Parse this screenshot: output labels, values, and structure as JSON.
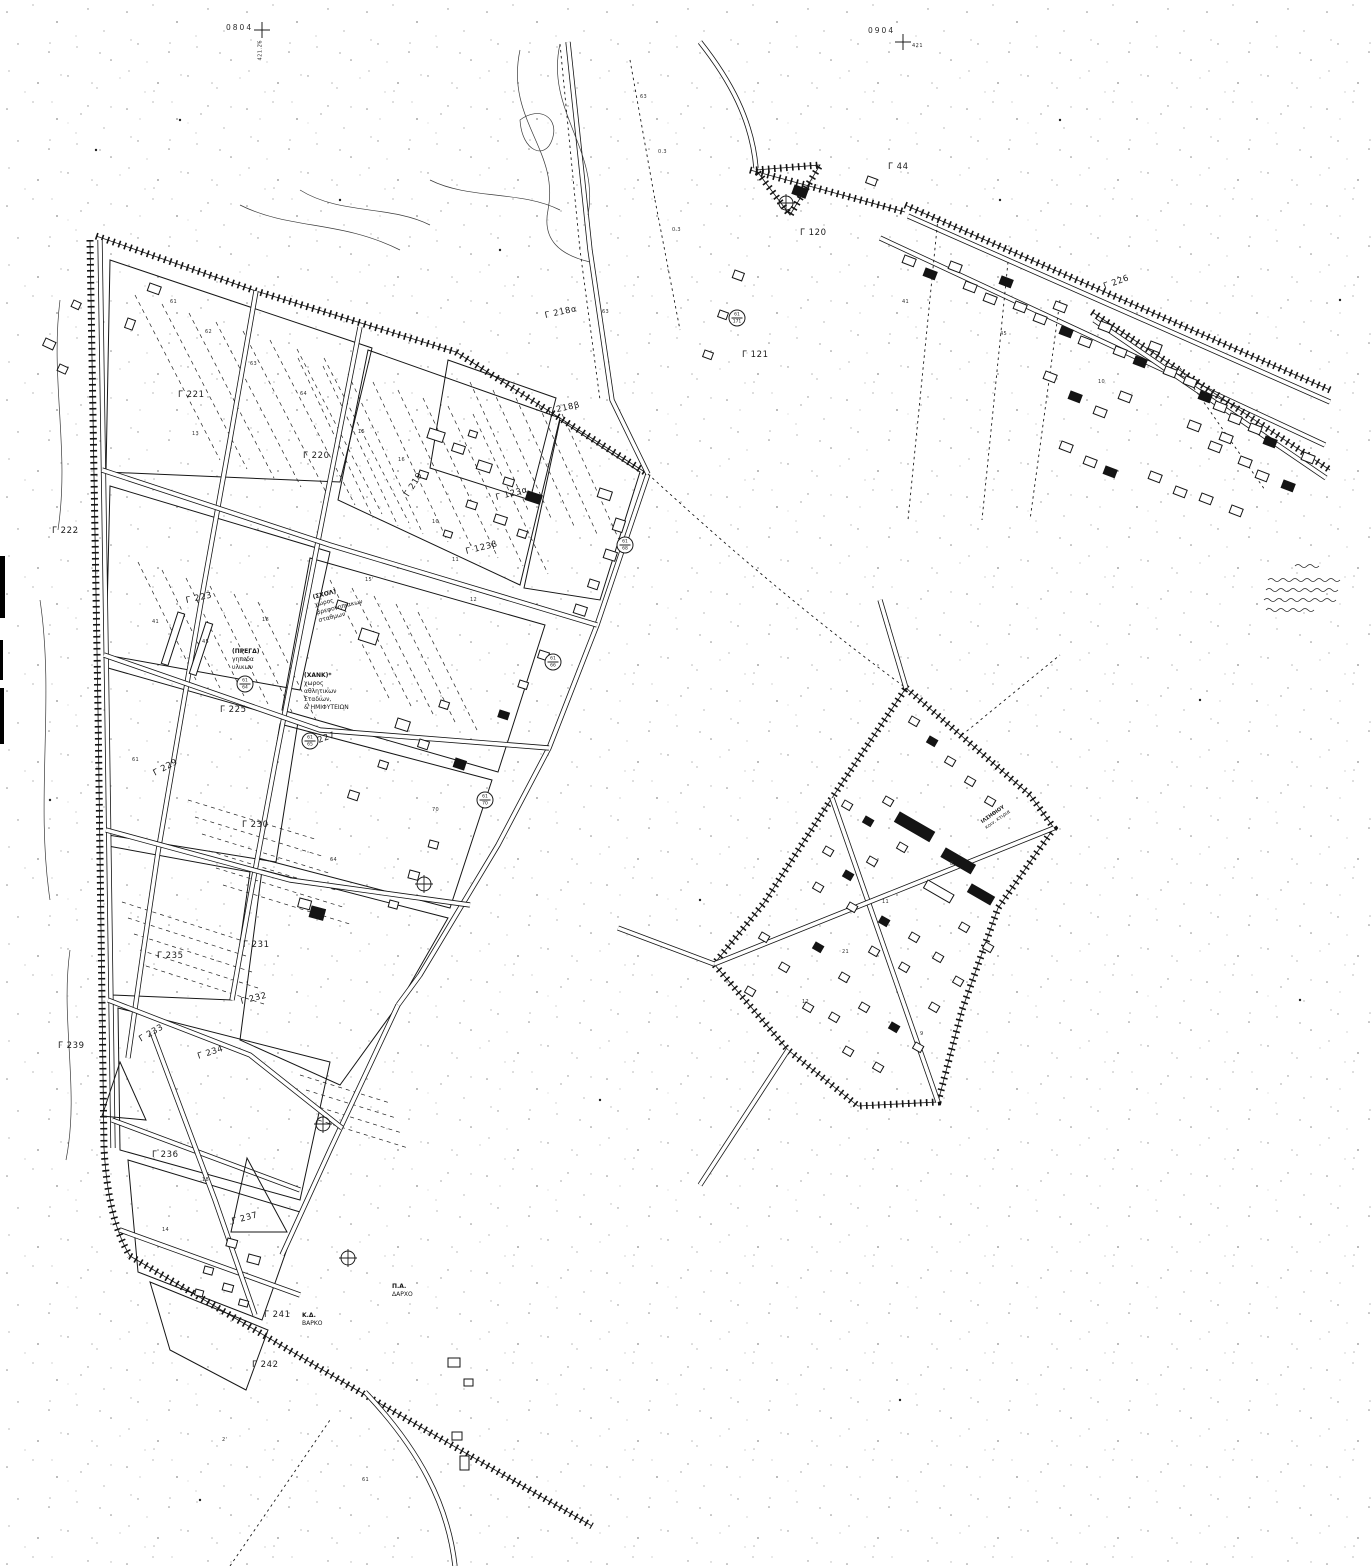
{
  "sheet": {
    "marks": [
      {
        "text": "0804",
        "x": 226,
        "y": 24
      },
      {
        "text": "0904",
        "x": 868,
        "y": 27
      }
    ],
    "grid_values": [
      {
        "text": "421.26",
        "x": 261,
        "y": 58,
        "vert": true
      },
      {
        "text": "421",
        "x": 912,
        "y": 44,
        "vert": false
      }
    ]
  },
  "block_labels": [
    {
      "text": "Γ 221",
      "x": 178,
      "y": 391,
      "rot": 0
    },
    {
      "text": "Γ 220",
      "x": 303,
      "y": 452,
      "rot": 0
    },
    {
      "text": "Γ 222",
      "x": 52,
      "y": 527,
      "rot": 0
    },
    {
      "text": "Γ 223",
      "x": 186,
      "y": 597,
      "rot": -12
    },
    {
      "text": "Γ 219",
      "x": 407,
      "y": 492,
      "rot": -58
    },
    {
      "text": "Γ 218α",
      "x": 545,
      "y": 312,
      "rot": -12
    },
    {
      "text": "Γ 218β",
      "x": 548,
      "y": 408,
      "rot": -12
    },
    {
      "text": "Γ 123α",
      "x": 496,
      "y": 494,
      "rot": -14
    },
    {
      "text": "Γ 123β",
      "x": 466,
      "y": 548,
      "rot": -14
    },
    {
      "text": "Γ 121",
      "x": 742,
      "y": 351,
      "rot": 0
    },
    {
      "text": "Γ 120",
      "x": 800,
      "y": 229,
      "rot": 0
    },
    {
      "text": "Γ 44",
      "x": 888,
      "y": 163,
      "rot": 0
    },
    {
      "text": "Γ 226",
      "x": 1104,
      "y": 283,
      "rot": -20
    },
    {
      "text": "Γ 225",
      "x": 220,
      "y": 706,
      "rot": 0
    },
    {
      "text": "Γ 227",
      "x": 310,
      "y": 740,
      "rot": -20
    },
    {
      "text": "Γ 229",
      "x": 154,
      "y": 770,
      "rot": -28
    },
    {
      "text": "Γ 230",
      "x": 242,
      "y": 821,
      "rot": 0
    },
    {
      "text": "Γ 231",
      "x": 243,
      "y": 941,
      "rot": 0
    },
    {
      "text": "Γ 235",
      "x": 157,
      "y": 952,
      "rot": 0
    },
    {
      "text": "Γ 232",
      "x": 241,
      "y": 998,
      "rot": -14
    },
    {
      "text": "Γ 233",
      "x": 140,
      "y": 1036,
      "rot": -30
    },
    {
      "text": "Γ 239",
      "x": 58,
      "y": 1042,
      "rot": 0
    },
    {
      "text": "Γ 234",
      "x": 198,
      "y": 1053,
      "rot": -18
    },
    {
      "text": "Γ 236",
      "x": 152,
      "y": 1151,
      "rot": 0
    },
    {
      "text": "Γ 237",
      "x": 232,
      "y": 1218,
      "rot": -15
    },
    {
      "text": "Γ 241",
      "x": 264,
      "y": 1311,
      "rot": 0
    },
    {
      "text": "Γ 242",
      "x": 252,
      "y": 1361,
      "rot": 0
    }
  ],
  "annotations": [
    {
      "x": 312,
      "y": 594,
      "rot": -14,
      "size": 6,
      "lines": [
        "(ΣΧΟΛ)",
        "χωρος",
        "βρεφονηπιακων",
        "σταθμων"
      ]
    },
    {
      "x": 232,
      "y": 648,
      "rot": 0,
      "size": 6,
      "lines": [
        "(ΠΡΕΓΔ)",
        "γηπεδα",
        "υλικων"
      ]
    },
    {
      "x": 304,
      "y": 672,
      "rot": 0,
      "size": 6,
      "lines": [
        "(ΧΑΝΚ)*",
        "χωρος",
        "αθλητικων",
        "Σταδιων,",
        "& ΗΜΙΦΥΤΕΙΩΝ"
      ]
    },
    {
      "x": 980,
      "y": 820,
      "rot": -35,
      "size": 5,
      "lines": [
        "ΙΛΣΗΘΙΟΥ",
        "κοιν. κτιρια"
      ]
    },
    {
      "x": 392,
      "y": 1283,
      "rot": 0,
      "size": 6,
      "lines": [
        "Π.Α.",
        "ΔΑΡΧΟ"
      ]
    },
    {
      "x": 302,
      "y": 1312,
      "rot": 0,
      "size": 6,
      "lines": [
        "Κ.Δ.",
        "ΒΑΡΚΟ"
      ]
    }
  ],
  "benchmarks": [
    {
      "x": 245,
      "y": 684,
      "top": "61",
      "bot": "64"
    },
    {
      "x": 310,
      "y": 741,
      "top": "61",
      "bot": "65"
    },
    {
      "x": 553,
      "y": 662,
      "top": "61",
      "bot": "66"
    },
    {
      "x": 737,
      "y": 318,
      "top": "61",
      "bot": "171"
    },
    {
      "x": 625,
      "y": 545,
      "top": "61",
      "bot": "68"
    },
    {
      "x": 485,
      "y": 800,
      "top": "61",
      "bot": "70"
    }
  ],
  "parcel_numbers": [
    {
      "t": "61",
      "x": 170,
      "y": 300
    },
    {
      "t": "62",
      "x": 205,
      "y": 330
    },
    {
      "t": "63",
      "x": 250,
      "y": 362
    },
    {
      "t": "64",
      "x": 300,
      "y": 392
    },
    {
      "t": "13",
      "x": 192,
      "y": 432
    },
    {
      "t": "15",
      "x": 358,
      "y": 430
    },
    {
      "t": "16",
      "x": 398,
      "y": 458
    },
    {
      "t": "41",
      "x": 152,
      "y": 620
    },
    {
      "t": "45",
      "x": 202,
      "y": 640
    },
    {
      "t": "18",
      "x": 262,
      "y": 618
    },
    {
      "t": "10",
      "x": 432,
      "y": 520
    },
    {
      "t": "11",
      "x": 452,
      "y": 558
    },
    {
      "t": "12",
      "x": 470,
      "y": 598
    },
    {
      "t": "70",
      "x": 432,
      "y": 808
    },
    {
      "t": "61",
      "x": 132,
      "y": 758
    },
    {
      "t": "64",
      "x": 330,
      "y": 858
    },
    {
      "t": "15'",
      "x": 365,
      "y": 578
    },
    {
      "t": "63",
      "x": 640,
      "y": 95
    },
    {
      "t": "0.3",
      "x": 658,
      "y": 150
    },
    {
      "t": "63",
      "x": 602,
      "y": 310
    },
    {
      "t": "0.3",
      "x": 672,
      "y": 228
    },
    {
      "t": "41",
      "x": 902,
      "y": 300
    },
    {
      "t": "45",
      "x": 1000,
      "y": 332
    },
    {
      "t": "10",
      "x": 1098,
      "y": 380
    },
    {
      "t": "8",
      "x": 950,
      "y": 862
    },
    {
      "t": "11",
      "x": 882,
      "y": 900
    },
    {
      "t": "21",
      "x": 842,
      "y": 950
    },
    {
      "t": "12",
      "x": 802,
      "y": 1000
    },
    {
      "t": "9",
      "x": 920,
      "y": 1032
    },
    {
      "t": "18",
      "x": 202,
      "y": 1178
    },
    {
      "t": "14",
      "x": 162,
      "y": 1228
    },
    {
      "t": "2'",
      "x": 222,
      "y": 1438
    },
    {
      "t": "61",
      "x": 362,
      "y": 1478
    }
  ]
}
